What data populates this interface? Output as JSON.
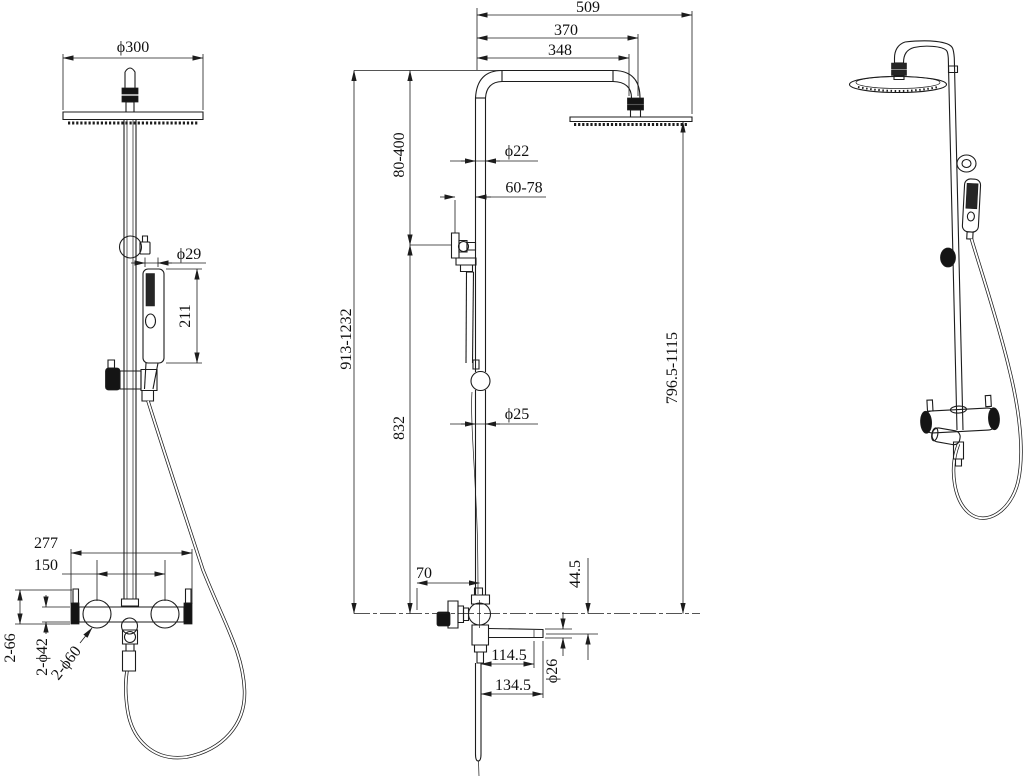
{
  "drawing_title": "shower-system-technical-drawing",
  "colors": {
    "background": "#ffffff",
    "line": "#1c1c1c",
    "solid_fill": "#141414"
  },
  "views": {
    "front": {
      "dims": {
        "head_diameter": "ϕ300",
        "hand_shower_diameter": "ϕ29",
        "hand_shower_length": "211",
        "valve_body_width": "277",
        "handle_center_distance": "150",
        "handle_depth": "2-66",
        "handle_diameter": "2-ϕ42",
        "escutcheon_diameter": "2-ϕ60"
      }
    },
    "side": {
      "dims": {
        "overall_reach": "509",
        "head_center_reach": "370",
        "arm_length": "348",
        "head_height_adjustment": "80-400",
        "upper_pipe_diameter": "ϕ22",
        "wall_bracket_depth": "60-78",
        "overall_height": "913-1232",
        "lower_column_height": "832",
        "lower_pipe_diameter": "ϕ25",
        "head_above_valve": "796.5-1115",
        "valve_depth": "70",
        "spout_drop": "44.5",
        "spout_reach_inner": "114.5",
        "spout_reach_outer": "134.5",
        "spout_diameter": "ϕ26"
      }
    }
  }
}
